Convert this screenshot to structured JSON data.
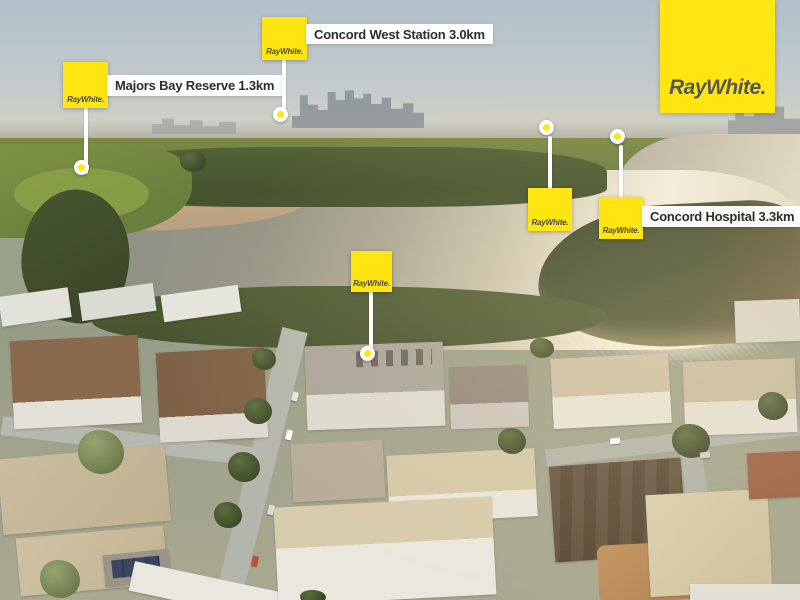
{
  "brand": {
    "logo_text": "RayWhite.",
    "pin_text": "RayWhite."
  },
  "theme": {
    "brand_yellow": "#FFE512",
    "logo_text": "#54565A",
    "label_text": "#2D2D2D",
    "marker_white": "#FFFFFF"
  },
  "markers": [
    {
      "id": "majors-bay-reserve",
      "label": "Majors Bay Reserve 1.3km"
    },
    {
      "id": "concord-west-station",
      "label": "Concord West Station 3.0km"
    },
    {
      "id": "concord-west-public-school",
      "label": "Concord West Public School 3.4km"
    },
    {
      "id": "concord-hospital",
      "label": "Concord Hospital 3.3km"
    },
    {
      "id": "subject-property",
      "label": "302/5 Northcote St"
    }
  ]
}
